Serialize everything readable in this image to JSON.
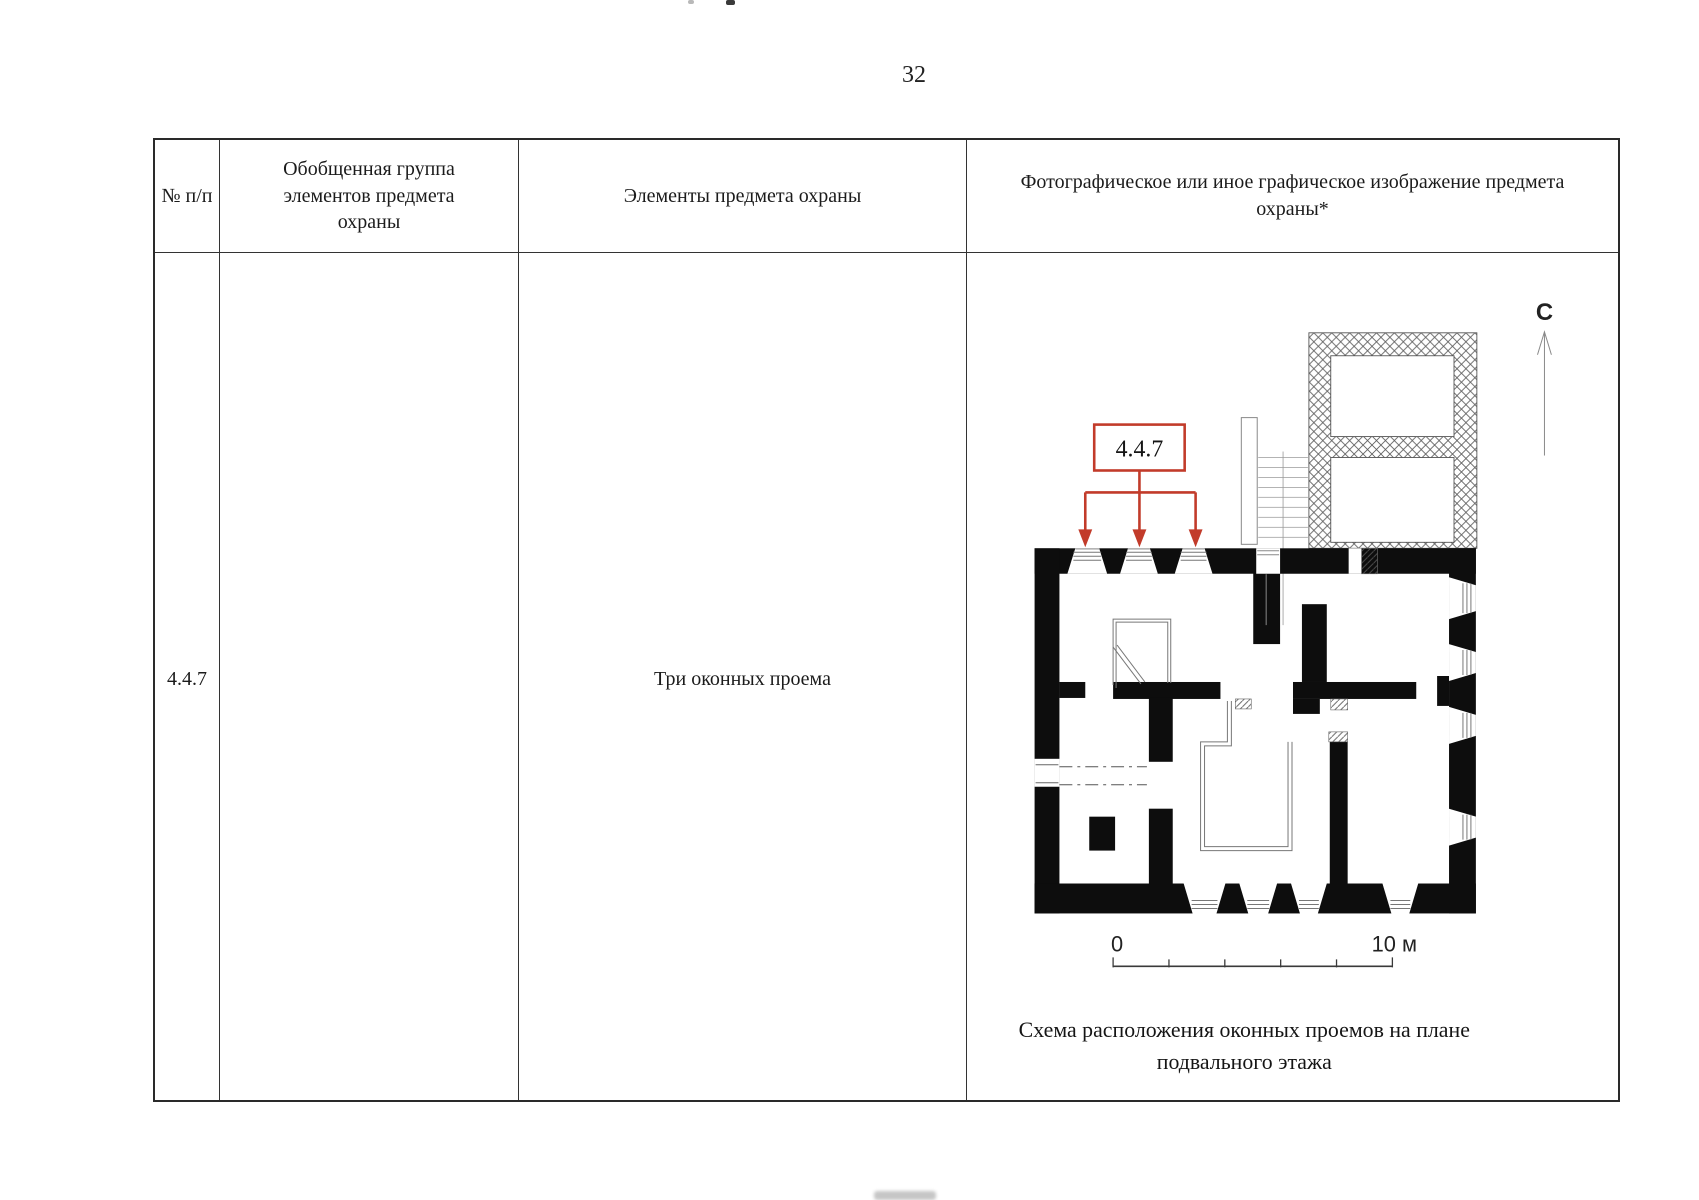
{
  "page": {
    "number": "32"
  },
  "table": {
    "headers": {
      "col1": "№ п/п",
      "col2": "Обобщенная группа элементов предмета охраны",
      "col3": "Элементы предмета охраны",
      "col4": "Фотографическое или иное графическое изображение предмета охраны*"
    },
    "row": {
      "number": "4.4.7",
      "group": "",
      "element": "Три оконных проема"
    }
  },
  "diagram": {
    "annotation_label": "4.4.7",
    "north_label": "С",
    "scale_start": "0",
    "scale_end": "10 м",
    "caption_line1": "Схема расположения оконных проемов на плане",
    "caption_line2": "подвального этажа",
    "colors": {
      "annotation_red": "#c23b2a",
      "wall_black": "#0d0d0d"
    }
  }
}
